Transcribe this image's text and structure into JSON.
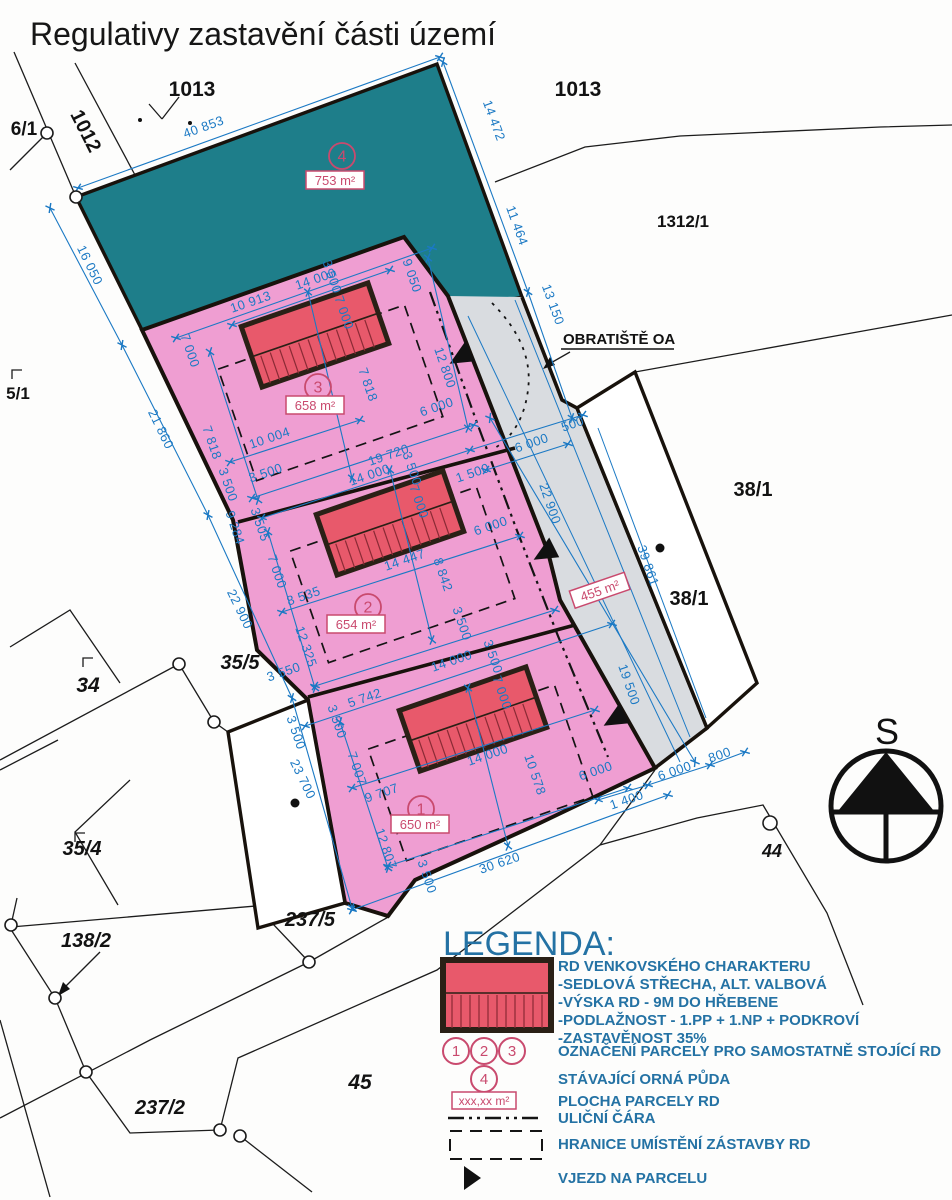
{
  "title": "Regulativy zastavění části území",
  "compass": {
    "label": "S"
  },
  "colors": {
    "teal": "#1e7e8a",
    "pink": "#ef9ed2",
    "road_grey": "#d9dce0",
    "building_red": "#e8596b",
    "dim_blue": "#1b79c4",
    "annotation_red": "#c94a6e",
    "legend_blue": "#2472a4"
  },
  "map": {
    "parcel_labels": [
      {
        "t": "1013",
        "x": 192,
        "y": 96,
        "fs": 21
      },
      {
        "t": "1013",
        "x": 578,
        "y": 96,
        "fs": 21
      },
      {
        "t": "1312/1",
        "x": 683,
        "y": 227,
        "fs": 17
      },
      {
        "t": "6/1",
        "x": 24,
        "y": 135,
        "fs": 19
      },
      {
        "t": "1012",
        "x": 80,
        "y": 134,
        "fs": 20,
        "r": 63
      },
      {
        "t": "5/1",
        "x": 18,
        "y": 399,
        "fs": 17
      },
      {
        "t": "38/1",
        "x": 753,
        "y": 496,
        "fs": 20
      },
      {
        "t": "38/1",
        "x": 689,
        "y": 605,
        "fs": 20
      },
      {
        "t": "34",
        "x": 88,
        "y": 692,
        "fs": 21,
        "i": 1
      },
      {
        "t": "35/5",
        "x": 240,
        "y": 669,
        "fs": 20,
        "i": 1
      },
      {
        "t": "35/4",
        "x": 82,
        "y": 855,
        "fs": 20,
        "i": 1
      },
      {
        "t": "138/2",
        "x": 86,
        "y": 947,
        "fs": 20,
        "i": 1
      },
      {
        "t": "237/5",
        "x": 310,
        "y": 926,
        "fs": 20,
        "i": 1
      },
      {
        "t": "237/2",
        "x": 160,
        "y": 1114,
        "fs": 20,
        "i": 1
      },
      {
        "t": "45",
        "x": 360,
        "y": 1089,
        "fs": 21,
        "i": 1
      },
      {
        "t": "44",
        "x": 772,
        "y": 857,
        "fs": 18,
        "i": 1
      },
      {
        "t": "OBRATIŠTĚ OA",
        "x": 563,
        "y": 344,
        "fs": 15,
        "anchor": "start"
      }
    ],
    "plot_numbers": [
      {
        "n": "1",
        "x": 421,
        "y": 809
      },
      {
        "n": "2",
        "x": 368,
        "y": 607
      },
      {
        "n": "3",
        "x": 318,
        "y": 387
      },
      {
        "n": "4",
        "x": 342,
        "y": 156
      }
    ],
    "area_labels": [
      {
        "t": "753 m²",
        "x": 335,
        "y": 184,
        "r": 0
      },
      {
        "t": "658 m²",
        "x": 315,
        "y": 409,
        "r": 0
      },
      {
        "t": "654 m²",
        "x": 356,
        "y": 628,
        "r": 0
      },
      {
        "t": "650 m²",
        "x": 420,
        "y": 828,
        "r": 0
      },
      {
        "t": "455 m²",
        "x": 601,
        "y": 594,
        "r": -19
      }
    ],
    "dimensions": [
      {
        "t": "40 853",
        "x": 205,
        "y": 131,
        "r": -20
      },
      {
        "t": "14 472",
        "x": 490,
        "y": 122,
        "r": 70
      },
      {
        "t": "11 464",
        "x": 513,
        "y": 227,
        "r": 70
      },
      {
        "t": "13 150",
        "x": 549,
        "y": 306,
        "r": 70
      },
      {
        "t": "16 050",
        "x": 86,
        "y": 267,
        "r": 64
      },
      {
        "t": "21 860",
        "x": 157,
        "y": 431,
        "r": 64
      },
      {
        "t": "22 900",
        "x": 236,
        "y": 611,
        "r": 64
      },
      {
        "t": "23 700",
        "x": 299,
        "y": 781,
        "r": 64
      },
      {
        "t": "10 913",
        "x": 252,
        "y": 306,
        "r": -19
      },
      {
        "t": "14 000",
        "x": 317,
        "y": 283,
        "r": -19
      },
      {
        "t": "3 500",
        "x": 328,
        "y": 278,
        "r": 71
      },
      {
        "t": "7 000",
        "x": 340,
        "y": 314,
        "r": 71
      },
      {
        "t": "9 050",
        "x": 408,
        "y": 277,
        "r": 71
      },
      {
        "t": "12 800",
        "x": 441,
        "y": 369,
        "r": 71
      },
      {
        "t": "7 818",
        "x": 364,
        "y": 386,
        "r": 71
      },
      {
        "t": "6 000",
        "x": 438,
        "y": 411,
        "r": -19
      },
      {
        "t": "7 000",
        "x": 186,
        "y": 352,
        "r": 71
      },
      {
        "t": "7 818",
        "x": 208,
        "y": 444,
        "r": 71
      },
      {
        "t": "10 004",
        "x": 271,
        "y": 442,
        "r": -19
      },
      {
        "t": "19 720",
        "x": 390,
        "y": 459,
        "r": -19
      },
      {
        "t": "3 500",
        "x": 267,
        "y": 477,
        "r": -19
      },
      {
        "t": "3 500",
        "x": 224,
        "y": 486,
        "r": 71
      },
      {
        "t": "14 000",
        "x": 371,
        "y": 479,
        "r": -19
      },
      {
        "t": "3 500",
        "x": 408,
        "y": 470,
        "r": 71
      },
      {
        "t": "7 000",
        "x": 415,
        "y": 503,
        "r": 71
      },
      {
        "t": "1 500",
        "x": 474,
        "y": 477,
        "r": -19
      },
      {
        "t": "6 000",
        "x": 533,
        "y": 447,
        "r": -19
      },
      {
        "t": "500",
        "x": 574,
        "y": 428,
        "r": -19
      },
      {
        "t": "22 900",
        "x": 546,
        "y": 505,
        "r": 71
      },
      {
        "t": "9 284",
        "x": 231,
        "y": 529,
        "r": 71
      },
      {
        "t": "3 505",
        "x": 256,
        "y": 526,
        "r": 71
      },
      {
        "t": "7 000",
        "x": 273,
        "y": 573,
        "r": 71
      },
      {
        "t": "8 535",
        "x": 305,
        "y": 600,
        "r": -19
      },
      {
        "t": "14 447",
        "x": 406,
        "y": 564,
        "r": -19
      },
      {
        "t": "8 842",
        "x": 439,
        "y": 576,
        "r": 71
      },
      {
        "t": "6 000",
        "x": 492,
        "y": 530,
        "r": -19
      },
      {
        "t": "3 500",
        "x": 458,
        "y": 625,
        "r": 71
      },
      {
        "t": "3 500",
        "x": 489,
        "y": 658,
        "r": 71
      },
      {
        "t": "12 325",
        "x": 302,
        "y": 648,
        "r": 71
      },
      {
        "t": "3 550",
        "x": 285,
        "y": 676,
        "r": -19
      },
      {
        "t": "5 742",
        "x": 366,
        "y": 702,
        "r": -19
      },
      {
        "t": "14 000",
        "x": 453,
        "y": 665,
        "r": -19
      },
      {
        "t": "7 000",
        "x": 498,
        "y": 694,
        "r": 71
      },
      {
        "t": "3 500",
        "x": 333,
        "y": 723,
        "r": 71
      },
      {
        "t": "3 500",
        "x": 292,
        "y": 734,
        "r": 71
      },
      {
        "t": "7 007",
        "x": 353,
        "y": 770,
        "r": 71
      },
      {
        "t": "9 707",
        "x": 383,
        "y": 797,
        "r": -19
      },
      {
        "t": "12 807",
        "x": 382,
        "y": 850,
        "r": 71
      },
      {
        "t": "3 500",
        "x": 423,
        "y": 878,
        "r": 71
      },
      {
        "t": "14 000",
        "x": 489,
        "y": 759,
        "r": -19
      },
      {
        "t": "10 578",
        "x": 531,
        "y": 776,
        "r": 71
      },
      {
        "t": "6 000",
        "x": 597,
        "y": 775,
        "r": -19
      },
      {
        "t": "30 620",
        "x": 501,
        "y": 867,
        "r": -19
      },
      {
        "t": "1 400",
        "x": 628,
        "y": 804,
        "r": -19
      },
      {
        "t": "6 000",
        "x": 676,
        "y": 775,
        "r": -19
      },
      {
        "t": "800",
        "x": 721,
        "y": 759,
        "r": -19
      },
      {
        "t": "19 500",
        "x": 625,
        "y": 686,
        "r": 71
      },
      {
        "t": "39 861",
        "x": 644,
        "y": 567,
        "r": 71
      }
    ]
  },
  "legend": {
    "title": "LEGENDA:",
    "rd": {
      "title": "RD VENKOVSKÉHO CHARAKTERU",
      "lines": [
        "-SEDLOVÁ STŘECHA, ALT. VALBOVÁ",
        "-VÝSKA RD - 9M DO HŘEBENE",
        "-PODLAŽNOST - 1.PP + 1.NP + PODKROVÍ",
        "-ZASTAVĚNOST 35%"
      ]
    },
    "plot_digits": [
      "1",
      "2",
      "3",
      "4"
    ],
    "items": [
      {
        "label": "OZNAČENÍ PARCELY PRO SAMOSTATNĚ STOJÍCÍ RD"
      },
      {
        "label": "STÁVAJÍCÍ ORNÁ PŮDA"
      },
      {
        "label": "PLOCHA PARCELY RD",
        "sample": "xxx,xx m²"
      },
      {
        "label": "ULIČNÍ ČÁRA"
      },
      {
        "label": "HRANICE UMÍSTĚNÍ ZÁSTAVBY RD"
      },
      {
        "label": "VJEZD NA PARCELU"
      }
    ]
  }
}
